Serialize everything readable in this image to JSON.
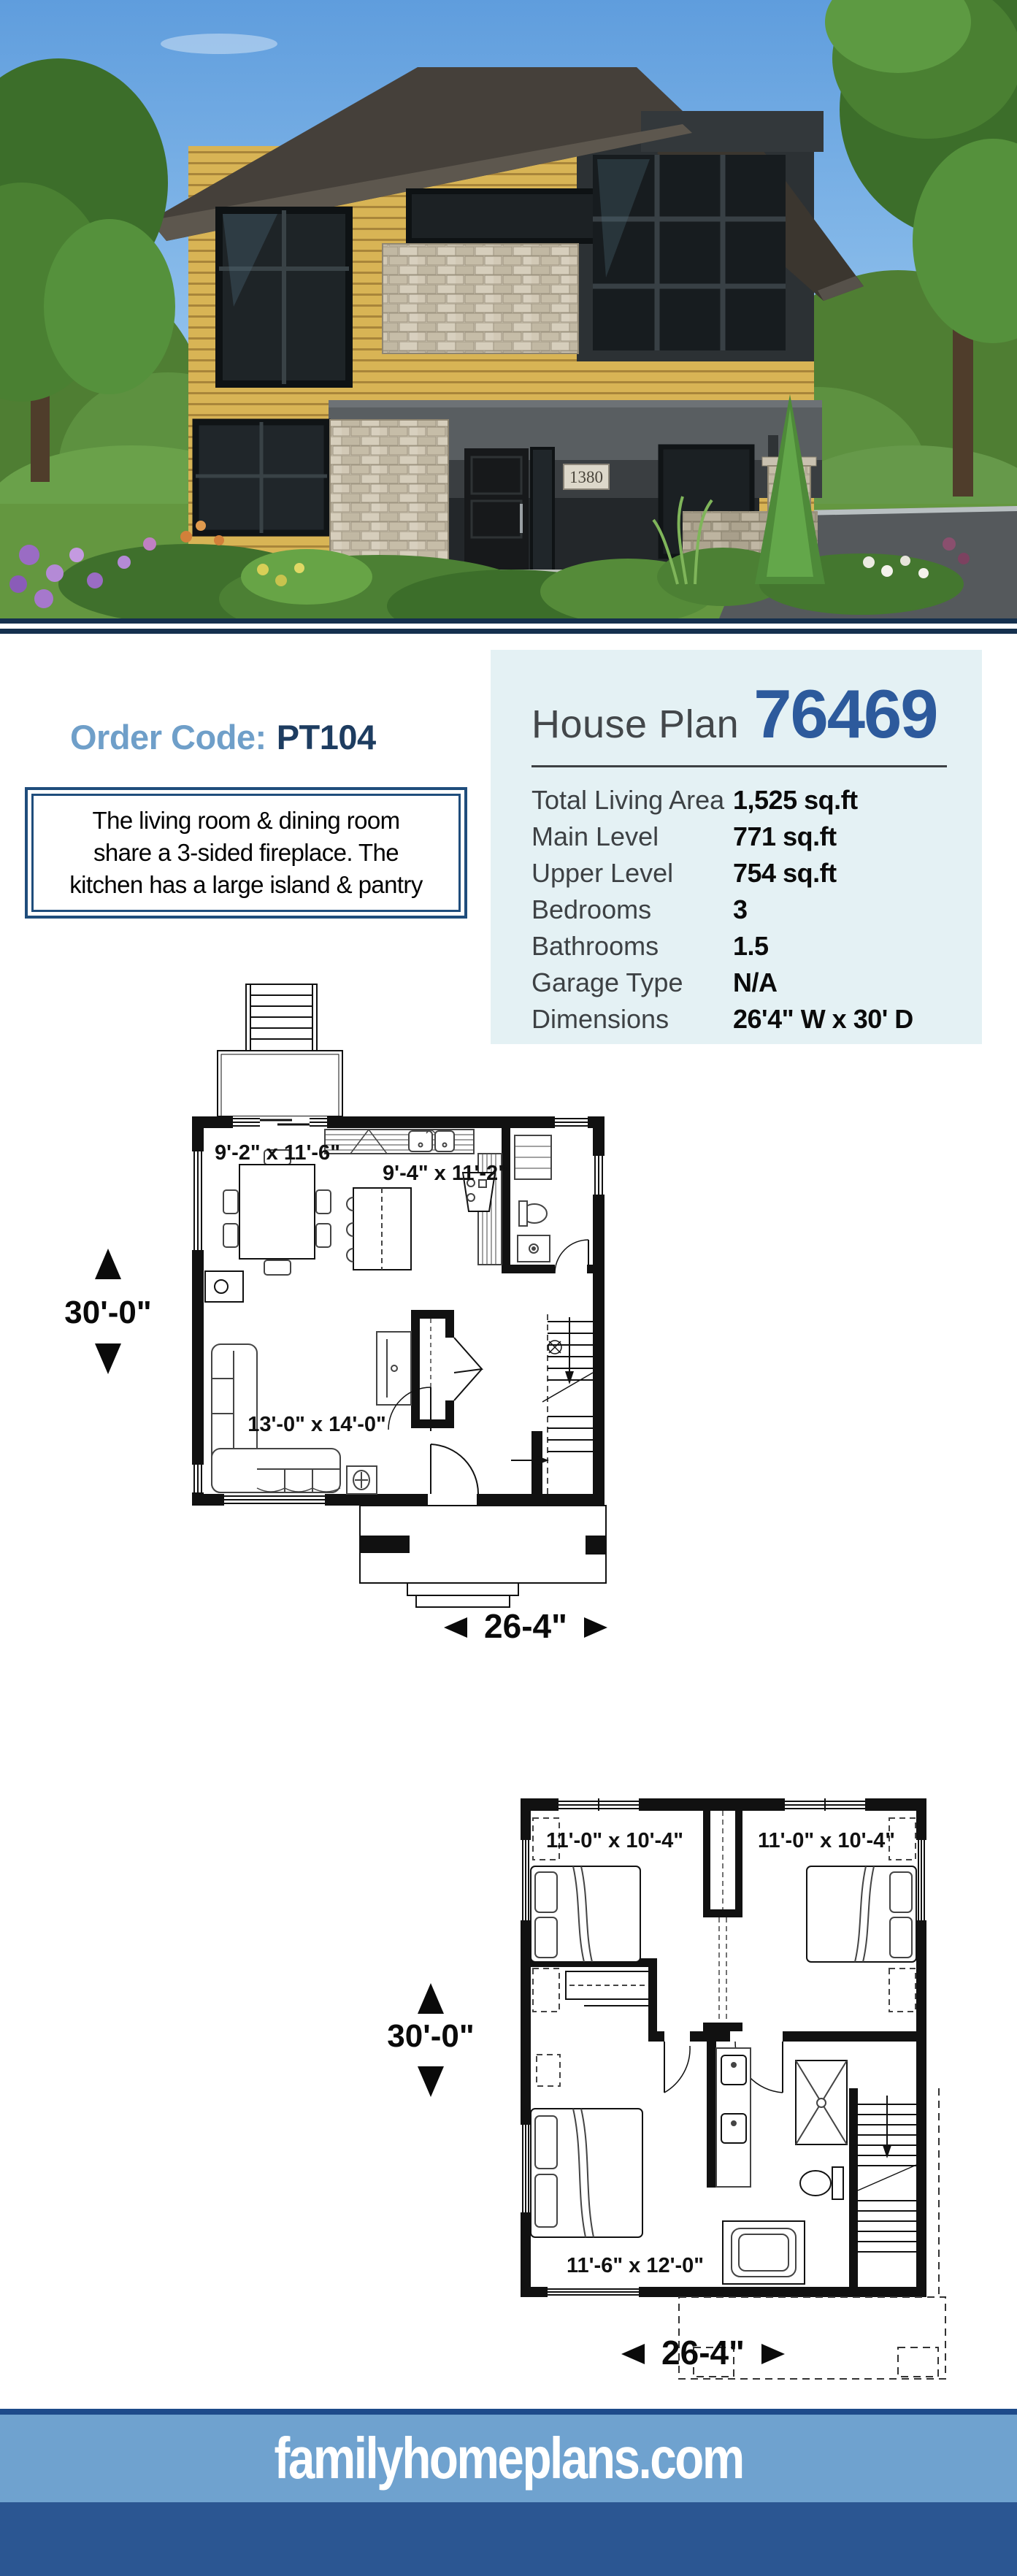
{
  "photo": {
    "house_number": "1380"
  },
  "order": {
    "label": "Order Code:",
    "code": "PT104"
  },
  "description": {
    "line1": "The living room & dining room",
    "line2": "share a 3-sided fireplace. The",
    "line3": "kitchen has a large island & pantry"
  },
  "plan_header": {
    "prefix": "House Plan",
    "number": "76469"
  },
  "specs": {
    "rows": [
      {
        "label": "Total Living Area",
        "value": "1,525 sq.ft"
      },
      {
        "label": "Main Level",
        "value": "771 sq.ft"
      },
      {
        "label": "Upper Level",
        "value": "754 sq.ft"
      },
      {
        "label": "Bedrooms",
        "value": "3"
      },
      {
        "label": "Bathrooms",
        "value": "1.5"
      },
      {
        "label": "Garage Type",
        "value": "N/A"
      },
      {
        "label": "Dimensions",
        "value": "26'4\" W x 30' D"
      }
    ]
  },
  "plans": {
    "main": {
      "depth_label": "30'-0\"",
      "width_label": "26-4\"",
      "rooms": [
        "9'-2\" x 11'-6\"",
        "9'-4\" x 11'-2\"",
        "13'-0\" x 14'-0\""
      ]
    },
    "upper": {
      "depth_label": "30'-0\"",
      "width_label": "26-4\"",
      "rooms": [
        "11'-0\" x 10'-4\"",
        "11'-0\" x 10'-4\"",
        "11'-6\" x 12'-0\""
      ]
    }
  },
  "footer": {
    "site": "familyhomeplans.com"
  },
  "colors": {
    "navy_separator": "#15304e",
    "accent_blue": "#2d5a9c",
    "light_blue": "#6f9fc9",
    "panel_bg": "#e4f1f4",
    "footer_light": "#6fa2cf",
    "footer_dark": "#2b5692",
    "border_navy": "#1f4d7c"
  }
}
